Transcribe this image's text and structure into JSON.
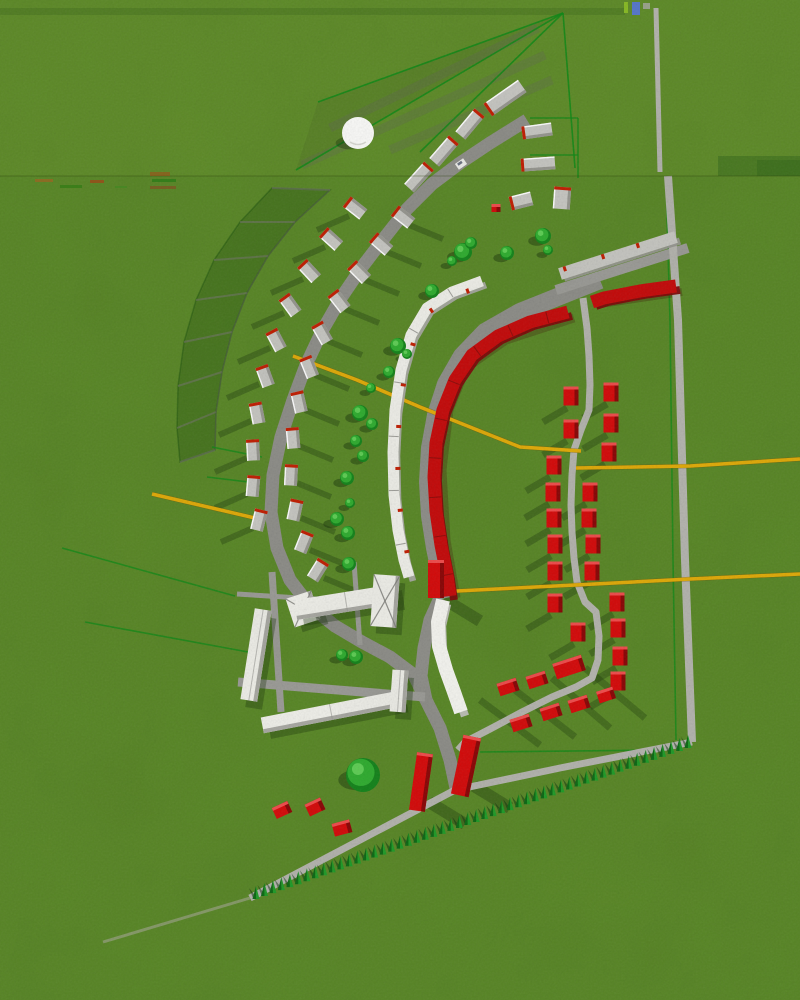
{
  "meta": {
    "title": "3D aerial site plan rendering",
    "width": 800,
    "height": 1000
  },
  "colors": {
    "grass": "#588724",
    "grass_top_tint": "rgba(190,210,80,0.06)",
    "road": "#9b9b96",
    "road_dark": "#8d8d88",
    "path": "#b4b4ae",
    "path_tail": "#9aa284",
    "red_bright": "#d60808",
    "red_band": "#c50808",
    "red_dark": "#7c0606",
    "red_top": "#f14b4b",
    "red_tick": "#c21c00",
    "white_face": "#f0f0ea",
    "white_side": "#a8a8a2",
    "gray_face": "#c7c7c2",
    "gray_side": "#96968f",
    "tree_dark": "#128419",
    "tree_mid": "#2eae2e",
    "tree_light": "#5ecf54",
    "hedge_dark": "#0a6912",
    "hedge_light": "#1d9c26",
    "plot_green": "#0c8a14",
    "yellow": "#e2ab06",
    "shadow": "rgba(22,50,8,0.33)",
    "shadow_strong": "rgba(18,45,8,0.42)",
    "marker_green": "#88bb22",
    "marker_blue": "#5577cc",
    "sphere": "#fbfbf9"
  },
  "seam": {
    "y": 176,
    "top_strip_y": 8,
    "noise_dashes": [
      [
        35,
        179,
        18,
        3,
        "rgba(179,90,32,0.55)"
      ],
      [
        60,
        185,
        22,
        3,
        "rgba(42,122,16,0.6)"
      ],
      [
        90,
        180,
        14,
        3,
        "rgba(194,40,16,0.5)"
      ],
      [
        115,
        186,
        12,
        2,
        "rgba(58,138,32,0.5)"
      ],
      [
        150,
        172,
        20,
        4,
        "rgba(180,60,20,0.45)"
      ],
      [
        152,
        179,
        24,
        3,
        "rgba(30,120,20,0.6)"
      ],
      [
        150,
        186,
        26,
        3,
        "rgba(150,50,30,0.45)"
      ]
    ]
  },
  "dark_patches": [
    [
      718,
      156,
      82,
      20,
      0.22
    ],
    [
      757,
      160,
      43,
      16,
      0.15
    ]
  ],
  "roads": {
    "main": {
      "pts": [
        [
          527,
          120
        ],
        [
          490,
          143
        ],
        [
          460,
          163
        ],
        [
          432,
          184
        ],
        [
          407,
          209
        ],
        [
          385,
          237
        ],
        [
          362,
          267
        ],
        [
          341,
          298
        ],
        [
          322,
          331
        ],
        [
          306,
          365
        ],
        [
          293,
          400
        ],
        [
          281,
          437
        ],
        [
          273,
          475
        ],
        [
          271,
          512
        ],
        [
          277,
          548
        ],
        [
          290,
          580
        ],
        [
          310,
          606
        ],
        [
          335,
          626
        ],
        [
          362,
          642
        ],
        [
          390,
          657
        ],
        [
          414,
          675
        ],
        [
          426,
          700
        ],
        [
          440,
          728
        ],
        [
          450,
          760
        ],
        [
          456,
          788
        ]
      ],
      "w": 13,
      "c": "road_dark"
    },
    "inner": {
      "pts": [
        [
          600,
          280
        ],
        [
          560,
          296
        ],
        [
          520,
          312
        ],
        [
          485,
          332
        ],
        [
          462,
          356
        ],
        [
          446,
          384
        ],
        [
          436,
          415
        ],
        [
          430,
          448
        ],
        [
          428,
          482
        ],
        [
          430,
          516
        ],
        [
          435,
          548
        ],
        [
          441,
          576
        ],
        [
          446,
          598
        ]
      ],
      "w": 18,
      "c": "road_dark"
    },
    "inner_south": {
      "pts": [
        [
          440,
          598
        ],
        [
          430,
          620
        ],
        [
          424,
          648
        ],
        [
          421,
          676
        ],
        [
          426,
          700
        ]
      ],
      "w": 13,
      "c": "road_dark"
    },
    "r1_top": {
      "pts": [
        [
          656,
          8
        ],
        [
          660,
          172
        ]
      ],
      "w": 5,
      "c": "path"
    },
    "r1": {
      "pts": [
        [
          668,
          176
        ],
        [
          678,
          320
        ],
        [
          685,
          560
        ],
        [
          692,
          742
        ]
      ],
      "w": 8,
      "c": "path"
    },
    "r2": {
      "pts": [
        [
          556,
          290
        ],
        [
          688,
          248
        ]
      ],
      "w": 10,
      "c": "road"
    },
    "grid_path": {
      "pts": [
        [
          583,
          298
        ],
        [
          587,
          328
        ],
        [
          589,
          356
        ],
        [
          590,
          385
        ],
        [
          589,
          410
        ],
        [
          581,
          430
        ],
        [
          574,
          450
        ],
        [
          572,
          475
        ],
        [
          571,
          505
        ],
        [
          572,
          532
        ],
        [
          574,
          558
        ],
        [
          577,
          582
        ],
        [
          585,
          602
        ],
        [
          596,
          612
        ],
        [
          599,
          636
        ],
        [
          598,
          660
        ],
        [
          592,
          678
        ],
        [
          576,
          687
        ],
        [
          552,
          697
        ],
        [
          522,
          712
        ],
        [
          492,
          728
        ],
        [
          465,
          742
        ],
        [
          458,
          750
        ]
      ],
      "w": 7,
      "c": "path"
    },
    "hedge_path": {
      "pts": [
        [
          692,
          742
        ],
        [
          560,
          768
        ],
        [
          455,
          790
        ],
        [
          250,
          898
        ]
      ],
      "w": 7,
      "c": "path"
    },
    "tail": {
      "pts": [
        [
          250,
          898
        ],
        [
          103,
          942
        ]
      ],
      "w": 3,
      "c": "path_tail",
      "op": 0.7
    },
    "strip1": {
      "pts": [
        [
          237,
          594
        ],
        [
          332,
          600
        ]
      ],
      "w": 5,
      "c": "road"
    },
    "strip2": {
      "pts": [
        [
          272,
          572
        ],
        [
          281,
          712
        ]
      ],
      "w": 7,
      "c": "road"
    },
    "strip3": {
      "pts": [
        [
          238,
          682
        ],
        [
          425,
          697
        ]
      ],
      "w": 9,
      "c": "road"
    },
    "strip4": {
      "pts": [
        [
          354,
          562
        ],
        [
          360,
          645
        ]
      ],
      "w": 5,
      "c": "road"
    }
  },
  "yellow_lines": [
    [
      [
        293,
        356
      ],
      [
        357,
        380
      ],
      [
        420,
        407
      ],
      [
        520,
        447
      ],
      [
        581,
        451
      ]
    ],
    [
      [
        576,
        468
      ],
      [
        690,
        466
      ],
      [
        800,
        459
      ]
    ],
    [
      [
        437,
        592
      ],
      [
        575,
        585
      ],
      [
        690,
        579
      ],
      [
        800,
        574
      ]
    ],
    [
      [
        152,
        494
      ],
      [
        255,
        518
      ]
    ]
  ],
  "fan": {
    "apex": [
      563,
      13
    ],
    "ends": [
      [
        296,
        170
      ],
      [
        318,
        102
      ],
      [
        420,
        152
      ],
      [
        575,
        168
      ]
    ],
    "shadow_strips": [
      [
        [
          538,
          28
        ],
        [
          330,
          128
        ]
      ],
      [
        [
          545,
          55
        ],
        [
          302,
          165
        ]
      ],
      [
        [
          552,
          80
        ],
        [
          390,
          150
        ]
      ]
    ],
    "wedge_fill": [
      [
        563,
        13
      ],
      [
        318,
        102
      ],
      [
        296,
        170
      ]
    ]
  },
  "plot_grid": {
    "inner": [
      [
        330,
        190
      ],
      [
        295,
        222
      ],
      [
        268,
        256
      ],
      [
        247,
        293
      ],
      [
        232,
        332
      ],
      [
        222,
        372
      ],
      [
        216,
        412
      ],
      [
        215,
        450
      ]
    ],
    "outer": [
      [
        272,
        188
      ],
      [
        240,
        222
      ],
      [
        214,
        260
      ],
      [
        196,
        300
      ],
      [
        184,
        342
      ],
      [
        178,
        386
      ],
      [
        177,
        428
      ],
      [
        180,
        462
      ]
    ]
  },
  "bands": {
    "red_a": {
      "pts": [
        [
          676,
          286
        ],
        [
          640,
          291
        ],
        [
          604,
          298
        ],
        [
          592,
          302
        ]
      ],
      "w": 13
    },
    "red_b": {
      "pts": [
        [
          568,
          312
        ],
        [
          530,
          322
        ],
        [
          498,
          336
        ],
        [
          472,
          355
        ],
        [
          455,
          380
        ],
        [
          443,
          410
        ],
        [
          436,
          443
        ],
        [
          434,
          477
        ],
        [
          436,
          511
        ],
        [
          441,
          545
        ],
        [
          447,
          575
        ],
        [
          450,
          596
        ]
      ],
      "w": 13
    },
    "white": {
      "pts": [
        [
          482,
          281
        ],
        [
          452,
          292
        ],
        [
          427,
          308
        ],
        [
          411,
          335
        ],
        [
          401,
          370
        ],
        [
          395,
          410
        ],
        [
          393,
          452
        ],
        [
          394,
          495
        ],
        [
          398,
          530
        ],
        [
          404,
          560
        ],
        [
          409,
          577
        ]
      ],
      "w": 11
    },
    "tower": {
      "pts": [
        [
          443,
          600
        ],
        [
          438,
          622
        ],
        [
          439,
          646
        ],
        [
          446,
          670
        ],
        [
          454,
          692
        ],
        [
          461,
          712
        ]
      ],
      "w": 14
    },
    "r2_building": {
      "pts": [
        [
          560,
          274
        ],
        [
          676,
          237
        ]
      ],
      "w": 12
    }
  },
  "gray_rows": {
    "row1": [
      [
        355,
        208,
        -52
      ],
      [
        331,
        239,
        -48
      ],
      [
        309,
        271,
        -43
      ],
      [
        290,
        305,
        -36
      ],
      [
        276,
        340,
        -28
      ],
      [
        265,
        376,
        -20
      ],
      [
        257,
        413,
        -11
      ],
      [
        253,
        450,
        -3
      ],
      [
        253,
        486,
        5
      ],
      [
        259,
        520,
        14
      ]
    ],
    "row2": [
      [
        403,
        217,
        -52
      ],
      [
        381,
        244,
        -49
      ],
      [
        359,
        272,
        -45
      ],
      [
        339,
        301,
        -38
      ],
      [
        322,
        333,
        -30
      ],
      [
        309,
        367,
        -22
      ],
      [
        299,
        402,
        -13
      ],
      [
        293,
        438,
        -5
      ],
      [
        291,
        475,
        3
      ],
      [
        295,
        510,
        12
      ],
      [
        304,
        542,
        22
      ],
      [
        318,
        570,
        32
      ]
    ],
    "size": [
      13,
      21
    ]
  },
  "top_houses": [
    [
      505,
      98,
      42,
      15,
      -35
    ],
    [
      537,
      131,
      30,
      13,
      -8
    ],
    [
      538,
      164,
      34,
      13,
      -4
    ],
    [
      562,
      198,
      17,
      22,
      4
    ],
    [
      521,
      201,
      22,
      14,
      -14
    ],
    [
      470,
      124,
      13,
      30,
      40
    ],
    [
      444,
      151,
      13,
      30,
      41
    ],
    [
      419,
      177,
      13,
      30,
      42
    ]
  ],
  "red_grid": {
    "size": [
      15,
      19
    ],
    "pts": [
      [
        571,
        396
      ],
      [
        611,
        392
      ],
      [
        571,
        429
      ],
      [
        611,
        423
      ],
      [
        554,
        465
      ],
      [
        609,
        452
      ],
      [
        553,
        492
      ],
      [
        590,
        492
      ],
      [
        554,
        518
      ],
      [
        589,
        518
      ],
      [
        555,
        544
      ],
      [
        593,
        544
      ],
      [
        555,
        571
      ],
      [
        592,
        571
      ],
      [
        555,
        603
      ],
      [
        578,
        632
      ],
      [
        617,
        602
      ],
      [
        618,
        628
      ],
      [
        620,
        656
      ],
      [
        618,
        681
      ]
    ]
  },
  "red_diag": [
    [
      508,
      687,
      20,
      13,
      -18
    ],
    [
      537,
      680,
      20,
      13,
      -18
    ],
    [
      569,
      667,
      30,
      16,
      -18
    ],
    [
      521,
      723,
      20,
      13,
      -18
    ],
    [
      551,
      712,
      20,
      13,
      -18
    ],
    [
      579,
      704,
      20,
      13,
      -18
    ],
    [
      606,
      695,
      17,
      12,
      -18
    ]
  ],
  "red_misc": [
    [
      282,
      810,
      17,
      12,
      -25
    ],
    [
      315,
      807,
      17,
      13,
      -25
    ],
    [
      342,
      828,
      18,
      13,
      -15
    ],
    [
      496,
      208,
      9,
      8,
      0
    ]
  ],
  "red_towers": [
    [
      436,
      579,
      16,
      38,
      0
    ],
    [
      421,
      782,
      16,
      58,
      8
    ],
    [
      466,
      766,
      18,
      60,
      12
    ]
  ],
  "white_buildings": [
    {
      "x": 256,
      "y": 655,
      "w": 17,
      "h": 92,
      "rot": 9,
      "pyr": false
    },
    {
      "x": 303,
      "y": 609,
      "w": 27,
      "h": 30,
      "rot": -18,
      "pyr": true
    },
    {
      "x": 346,
      "y": 602,
      "w": 102,
      "h": 20,
      "rot": -9,
      "pyr": false
    },
    {
      "x": 385,
      "y": 601,
      "w": 26,
      "h": 52,
      "rot": 4,
      "pyr": true
    },
    {
      "x": 331,
      "y": 712,
      "w": 140,
      "h": 16,
      "rot": -11,
      "pyr": false
    },
    {
      "x": 399,
      "y": 691,
      "w": 16,
      "h": 42,
      "rot": 4,
      "pyr": false
    }
  ],
  "trees": [
    [
      543,
      236,
      8
    ],
    [
      548,
      250,
      5
    ],
    [
      507,
      253,
      7
    ],
    [
      463,
      252,
      9
    ],
    [
      471,
      243,
      6
    ],
    [
      452,
      261,
      5
    ],
    [
      432,
      291,
      7
    ],
    [
      398,
      346,
      8
    ],
    [
      407,
      354,
      5
    ],
    [
      389,
      372,
      6
    ],
    [
      360,
      413,
      8
    ],
    [
      372,
      424,
      6
    ],
    [
      356,
      441,
      6
    ],
    [
      363,
      456,
      6
    ],
    [
      347,
      478,
      7
    ],
    [
      350,
      503,
      5
    ],
    [
      337,
      519,
      7
    ],
    [
      348,
      533,
      7
    ],
    [
      349,
      564,
      7
    ],
    [
      342,
      655,
      6
    ],
    [
      356,
      657,
      7
    ],
    [
      363,
      775,
      17
    ],
    [
      371,
      388,
      5
    ]
  ],
  "green_lines": [
    [
      [
        666,
        180
      ],
      [
        670,
        320
      ],
      [
        673,
        560
      ],
      [
        676,
        740
      ]
    ],
    [
      [
        480,
        752
      ],
      [
        660,
        750
      ]
    ],
    [
      [
        62,
        548
      ],
      [
        235,
        596
      ]
    ],
    [
      [
        85,
        622
      ],
      [
        248,
        652
      ]
    ],
    [
      [
        530,
        118
      ],
      [
        578,
        118
      ]
    ],
    [
      [
        530,
        155
      ],
      [
        578,
        155
      ]
    ],
    [
      [
        578,
        118
      ],
      [
        578,
        178
      ]
    ],
    [
      [
        212,
        447
      ],
      [
        262,
        457
      ]
    ],
    [
      [
        207,
        477
      ],
      [
        257,
        483
      ]
    ]
  ],
  "cluster_shadows": [
    [
      [
        480,
        700
      ],
      [
        540,
        745
      ]
    ],
    [
      [
        515,
        690
      ],
      [
        575,
        737
      ]
    ],
    [
      [
        552,
        678
      ],
      [
        610,
        728
      ]
    ],
    [
      [
        585,
        668
      ],
      [
        645,
        718
      ]
    ]
  ],
  "hedge": {
    "start": [
      256,
      899
    ],
    "end": [
      688,
      748
    ],
    "count": 52
  },
  "sphere": {
    "x": 358,
    "y": 133,
    "r": 16
  },
  "car": {
    "x": 461,
    "y": 164,
    "rot": -35
  },
  "marker": {
    "green": [
      624,
      2,
      4,
      11
    ],
    "blue": [
      632,
      2,
      8,
      13
    ],
    "gray": [
      643,
      3,
      7,
      6
    ]
  }
}
